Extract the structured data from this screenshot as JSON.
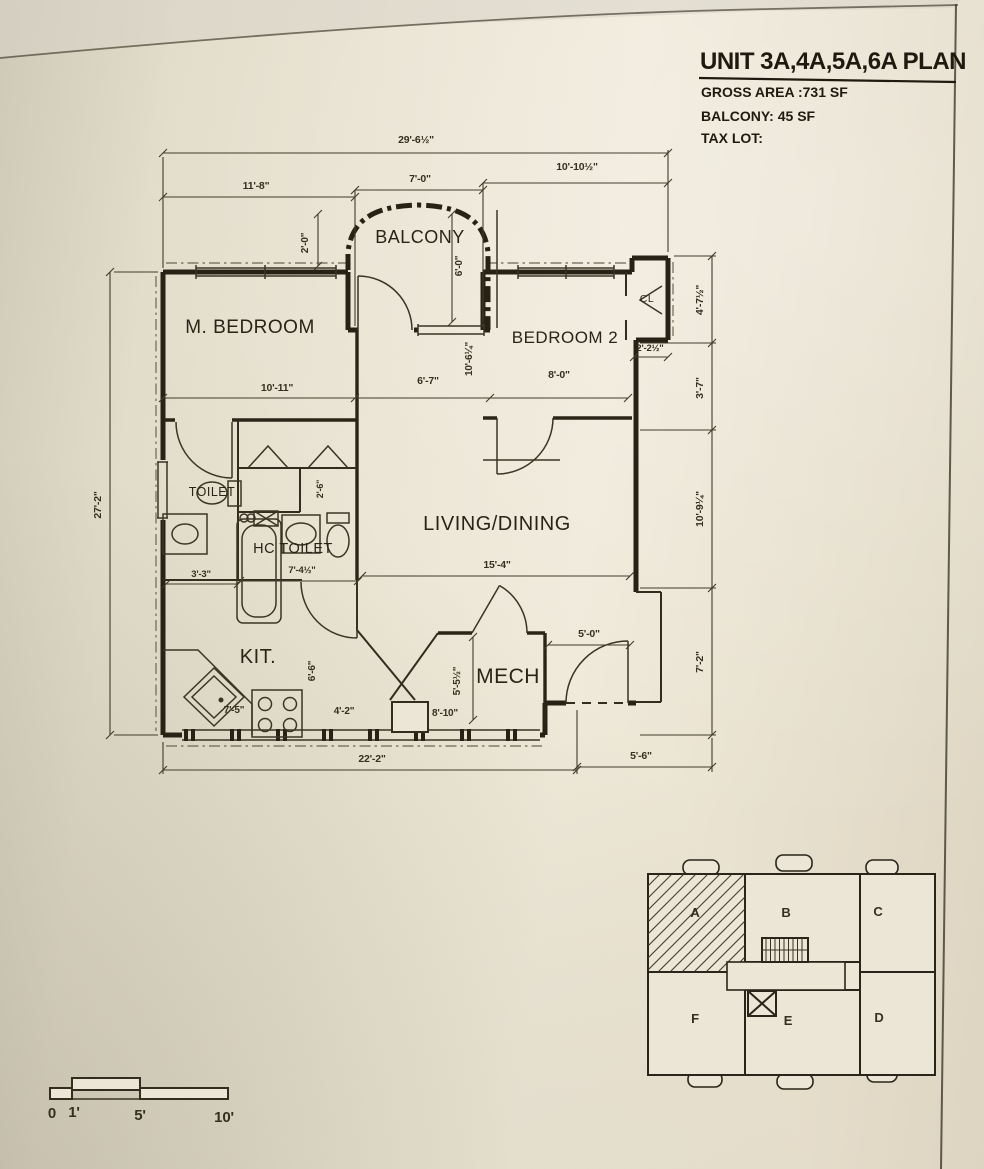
{
  "title_block": {
    "title": "UNIT 3A,4A,5A,6A PLAN",
    "gross_area": "GROSS AREA :731 SF",
    "balcony_area": "BALCONY: 45 SF",
    "tax_lot": "TAX LOT:"
  },
  "rooms": {
    "balcony": "BALCONY",
    "m_bedroom": "M. BEDROOM",
    "bedroom2": "BEDROOM 2",
    "closet": "CL",
    "living_dining": "LIVING/DINING",
    "toilet": "TOILET",
    "hc_toilet": "HC TOILET",
    "kitchen": "KIT.",
    "mech": "MECH"
  },
  "dims": {
    "overall_width": "29'-6½\"",
    "top_left": "11'-8\"",
    "top_mid": "7'-0\"",
    "top_right": "10'-10½\"",
    "left_height": "27'-2\"",
    "right_1": "4'-7½\"",
    "right_2": "3'-7\"",
    "right_3": "10'-9¼\"",
    "right_4": "7'-2\"",
    "balcony_depth": "2'-0\"",
    "balcony_width": "6'-0\"",
    "mbr_width": "10'-11\"",
    "mbr_height": "10'-6¼\"",
    "hall_width": "6'-7\"",
    "br2_width": "8'-0\"",
    "cl_width": "2'-2½\"",
    "toilet_width": "3'-3\"",
    "hc_width": "7'-4½\"",
    "hc_depth": "2'-6\"",
    "living_width": "15'-4\"",
    "kit_width": "7'-5\"",
    "kit_mid": "4'-2\"",
    "kit_height": "6'-6\"",
    "mech_height": "5'-5½\"",
    "mech_width": "8'-10\"",
    "entry_width": "5'-0\"",
    "bottom_left": "22'-2\"",
    "bottom_right": "5'-6\""
  },
  "key_plan": {
    "units": [
      "A",
      "B",
      "C",
      "D",
      "E",
      "F"
    ]
  },
  "scale_bar": {
    "ticks": [
      "0",
      "1'",
      "5'",
      "10'"
    ]
  }
}
